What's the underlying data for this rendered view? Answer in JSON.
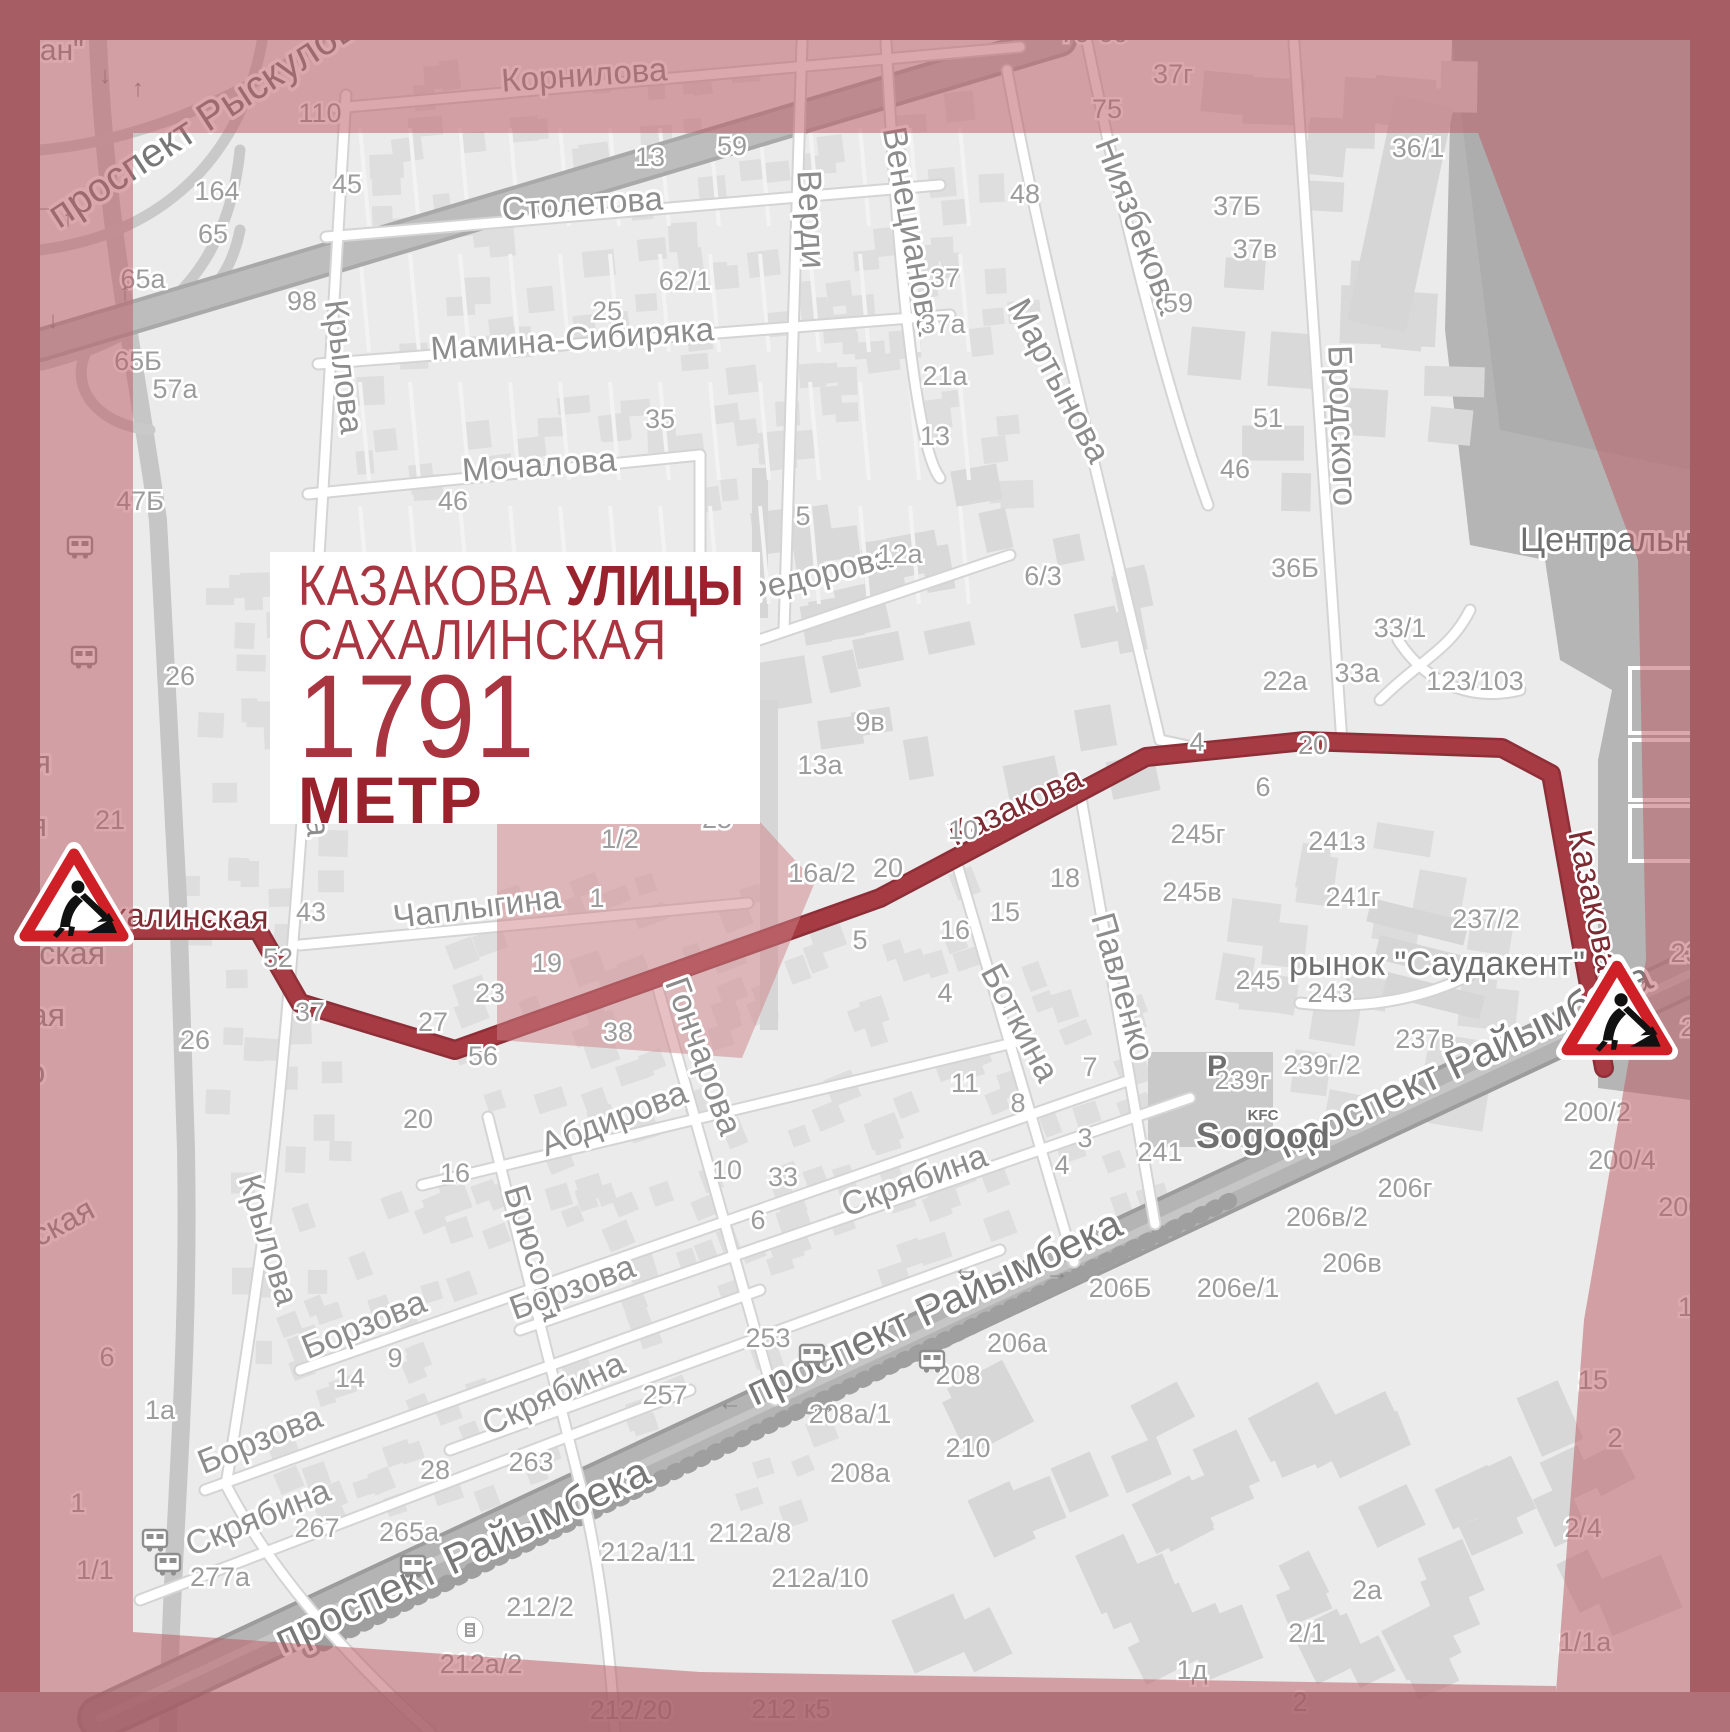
{
  "info_box": {
    "street1": "КАЗАКОВА",
    "kind": "УЛИЦЫ",
    "street2": "САХАЛИНСКАЯ",
    "distance": "1791",
    "unit": "МЕТР"
  },
  "colors": {
    "route": "#a63b44",
    "route_casing": "#8e2f38",
    "tint": "rgba(188,96,103,0.54)",
    "border": "#a65d64",
    "accent_red": "#cf2027",
    "label_gray": "#8d8d8d"
  },
  "route": {
    "name": "Казакова / Сахалинская",
    "points": [
      [
        126,
        930
      ],
      [
        258,
        930
      ],
      [
        300,
        1003
      ],
      [
        455,
        1050
      ],
      [
        880,
        898
      ],
      [
        1146,
        757
      ],
      [
        1305,
        741
      ],
      [
        1502,
        748
      ],
      [
        1551,
        774
      ],
      [
        1577,
        920
      ],
      [
        1604,
        1068
      ]
    ]
  },
  "signs": [
    {
      "name": "roadwork-sign-west"
    },
    {
      "name": "roadwork-sign-east"
    }
  ],
  "streets": [
    [
      "проспект Рыскулова",
      218,
      126,
      -33,
      40,
      "big"
    ],
    [
      "Корнилова",
      585,
      86,
      -4,
      33,
      "st"
    ],
    [
      "Столетова",
      583,
      215,
      -4,
      33,
      "st"
    ],
    [
      "Мамина-Сибиряка",
      573,
      350,
      -4,
      33,
      "st"
    ],
    [
      "Мочалова",
      540,
      476,
      -4,
      33,
      "st"
    ],
    [
      "Крылова",
      333,
      368,
      83,
      33,
      "st"
    ],
    [
      "Крылова",
      303,
      770,
      86,
      33,
      "st"
    ],
    [
      "Крылова",
      258,
      1243,
      73,
      33,
      "st"
    ],
    [
      "Верди",
      800,
      220,
      87,
      34,
      "st"
    ],
    [
      "Венецианова",
      901,
      233,
      80,
      34,
      "st"
    ],
    [
      "Мартынова",
      1049,
      386,
      62,
      34,
      "st"
    ],
    [
      "Ниязбекова",
      1128,
      230,
      69,
      34,
      "st"
    ],
    [
      "Бродского",
      1331,
      426,
      88,
      34,
      "st"
    ],
    [
      "Федорова",
      820,
      585,
      -14,
      33,
      "st"
    ],
    [
      "Чаплыгина",
      478,
      918,
      -7,
      33,
      "st"
    ],
    [
      "Сахалинская",
      168,
      927,
      1,
      33,
      "rt"
    ],
    [
      "Казакова",
      1020,
      816,
      -25,
      34,
      "rt"
    ],
    [
      "Казакова",
      1583,
      903,
      78,
      34,
      "rt"
    ],
    [
      "Гончарова",
      693,
      1060,
      70,
      34,
      "st"
    ],
    [
      "Боткина",
      1010,
      1028,
      62,
      34,
      "st"
    ],
    [
      "Павленко",
      1112,
      990,
      74,
      34,
      "st"
    ],
    [
      "Абдирова",
      618,
      1129,
      -21,
      34,
      "st"
    ],
    [
      "Брюсова",
      524,
      1256,
      73,
      34,
      "st"
    ],
    [
      "Борзова",
      368,
      1335,
      -22,
      34,
      "st"
    ],
    [
      "Борзова",
      264,
      1450,
      -22,
      34,
      "st"
    ],
    [
      "Борзова",
      576,
      1298,
      -20,
      34,
      "st"
    ],
    [
      "Скрябина",
      918,
      1191,
      -20,
      34,
      "st"
    ],
    [
      "Скрябина",
      558,
      1404,
      -25,
      34,
      "st"
    ],
    [
      "Скрябина",
      262,
      1528,
      -22,
      34,
      "st"
    ],
    [
      "проспект Райымбека",
      940,
      1320,
      -25,
      42,
      "big"
    ],
    [
      "проспект Райымбека",
      1470,
      1073,
      -25,
      42,
      "big"
    ],
    [
      "проспект Райымбека",
      468,
      1568,
      -25,
      42,
      "big"
    ],
    [
      "Центральный",
      1628,
      551,
      0,
      34,
      "dark"
    ],
    [
      "рынок \"Саудакент\"",
      1437,
      975,
      0,
      34,
      "dark"
    ],
    [
      "ауран\"",
      38,
      60,
      0,
      30,
      "st"
    ],
    [
      "ирская",
      52,
      1240,
      -28,
      32,
      "st"
    ],
    [
      "я",
      28,
      710,
      0,
      32,
      "st"
    ],
    [
      "кая",
      26,
      773,
      0,
      32,
      "st"
    ],
    [
      "кая",
      22,
      836,
      0,
      32,
      "st"
    ],
    [
      "ревская",
      46,
      964,
      0,
      32,
      "st"
    ],
    [
      "ская",
      32,
      1026,
      0,
      32,
      "st"
    ],
    [
      "ого",
      22,
      1083,
      0,
      32,
      "st"
    ]
  ],
  "numbers": [
    [
      "110",
      320,
      122
    ],
    [
      "164",
      217,
      200
    ],
    [
      "65",
      213,
      243
    ],
    [
      "45",
      347,
      193
    ],
    [
      "65а",
      143,
      288
    ],
    [
      "65Б",
      138,
      370
    ],
    [
      "98",
      302,
      310
    ],
    [
      "57а",
      175,
      398
    ],
    [
      "47Б",
      140,
      510
    ],
    [
      "26",
      180,
      685
    ],
    [
      "21",
      110,
      829
    ],
    [
      "46",
      453,
      510
    ],
    [
      "35",
      660,
      428
    ],
    [
      "13",
      650,
      166
    ],
    [
      "59",
      732,
      155
    ],
    [
      "62/1",
      685,
      290
    ],
    [
      "25",
      607,
      320
    ],
    [
      "48",
      1025,
      203
    ],
    [
      "37",
      945,
      287
    ],
    [
      "37а",
      943,
      333
    ],
    [
      "21а",
      945,
      385
    ],
    [
      "13",
      935,
      445
    ],
    [
      "5",
      803,
      525
    ],
    [
      "12а",
      900,
      563
    ],
    [
      "6/3",
      1043,
      585
    ],
    [
      "9в",
      870,
      731
    ],
    [
      "13а",
      820,
      774
    ],
    [
      "25",
      717,
      828
    ],
    [
      "1/2",
      620,
      848
    ],
    [
      "1",
      597,
      907
    ],
    [
      "132а/1",
      450,
      15
    ],
    [
      "37",
      800,
      17
    ],
    [
      "79",
      1075,
      42
    ],
    [
      "60",
      1113,
      42
    ],
    [
      "37г",
      1173,
      83
    ],
    [
      "75",
      1107,
      118
    ],
    [
      "36/1",
      1418,
      157
    ],
    [
      "37Б",
      1237,
      215
    ],
    [
      "37в",
      1255,
      258
    ],
    [
      "59",
      1178,
      312
    ],
    [
      "51",
      1268,
      427
    ],
    [
      "46",
      1235,
      478
    ],
    [
      "36Б",
      1295,
      577
    ],
    [
      "33/1",
      1400,
      637
    ],
    [
      "33а",
      1357,
      682
    ],
    [
      "22а",
      1285,
      690
    ],
    [
      "123/103",
      1475,
      690
    ],
    [
      "4",
      1197,
      751
    ],
    [
      "20",
      1313,
      754
    ],
    [
      "6",
      1263,
      796
    ],
    [
      "18",
      1065,
      887
    ],
    [
      "10",
      963,
      839
    ],
    [
      "20",
      888,
      877
    ],
    [
      "16а/2",
      822,
      882
    ],
    [
      "15",
      1005,
      921
    ],
    [
      "16",
      955,
      939
    ],
    [
      "5",
      860,
      949
    ],
    [
      "4",
      945,
      1002
    ],
    [
      "11",
      965,
      1092
    ],
    [
      "8",
      1018,
      1112
    ],
    [
      "7",
      1090,
      1076
    ],
    [
      "3",
      1085,
      1147
    ],
    [
      "4",
      1062,
      1174
    ],
    [
      "245г",
      1198,
      843
    ],
    [
      "245в",
      1192,
      901
    ],
    [
      "245",
      1258,
      989
    ],
    [
      "243",
      1330,
      1002
    ],
    [
      "241з",
      1337,
      850
    ],
    [
      "241г",
      1353,
      906
    ],
    [
      "241",
      1160,
      1161
    ],
    [
      "239г/2",
      1322,
      1074
    ],
    [
      "239г",
      1242,
      1089
    ],
    [
      "237/2",
      1486,
      928
    ],
    [
      "237в",
      1425,
      1048
    ],
    [
      "237",
      1693,
      962
    ],
    [
      "19",
      547,
      972
    ],
    [
      "23",
      490,
      1002
    ],
    [
      "27",
      433,
      1031
    ],
    [
      "37",
      310,
      1021
    ],
    [
      "52",
      278,
      967
    ],
    [
      "43",
      311,
      921
    ],
    [
      "56",
      483,
      1065
    ],
    [
      "38",
      618,
      1041
    ],
    [
      "20",
      418,
      1128
    ],
    [
      "26",
      195,
      1049
    ],
    [
      "10",
      727,
      1179
    ],
    [
      "33",
      783,
      1186
    ],
    [
      "6",
      758,
      1229
    ],
    [
      "16",
      455,
      1182
    ],
    [
      "9",
      395,
      1367
    ],
    [
      "14",
      350,
      1387
    ],
    [
      "1а",
      160,
      1419
    ],
    [
      "6",
      107,
      1366
    ],
    [
      "1",
      78,
      1512
    ],
    [
      "1/1",
      95,
      1579
    ],
    [
      "2",
      30,
      1601
    ],
    [
      "253",
      768,
      1347
    ],
    [
      "257",
      665,
      1404
    ],
    [
      "263",
      531,
      1471
    ],
    [
      "28",
      435,
      1479
    ],
    [
      "265а",
      409,
      1541
    ],
    [
      "267",
      317,
      1537
    ],
    [
      "277а",
      220,
      1586
    ],
    [
      "208а/1",
      850,
      1423
    ],
    [
      "208",
      958,
      1384
    ],
    [
      "208а",
      860,
      1482
    ],
    [
      "210",
      968,
      1457
    ],
    [
      "206а",
      1017,
      1352
    ],
    [
      "206Б",
      1120,
      1297
    ],
    [
      "206е/1",
      1238,
      1297
    ],
    [
      "206г",
      1405,
      1197
    ],
    [
      "206в/2",
      1327,
      1226
    ],
    [
      "206в",
      1352,
      1272
    ],
    [
      "212а/8",
      750,
      1542
    ],
    [
      "212а/11",
      648,
      1561
    ],
    [
      "212а/10",
      820,
      1587
    ],
    [
      "212/2",
      540,
      1616
    ],
    [
      "212а/2",
      481,
      1673
    ],
    [
      "212/20",
      631,
      1719
    ],
    [
      "212 к5",
      791,
      1718
    ],
    [
      "200/2",
      1597,
      1121
    ],
    [
      "200/4",
      1622,
      1169
    ],
    [
      "200/6",
      1692,
      1216
    ],
    [
      "200",
      1703,
      1036
    ],
    [
      "15",
      1693,
      1316
    ],
    [
      "15",
      1593,
      1389
    ],
    [
      "2",
      1615,
      1447
    ],
    [
      "2/4",
      1583,
      1537
    ],
    [
      "1/1а",
      1585,
      1651
    ],
    [
      "2а",
      1367,
      1599
    ],
    [
      "2/1",
      1307,
      1642
    ],
    [
      "1д",
      1192,
      1679
    ],
    [
      "2",
      1300,
      1711
    ]
  ],
  "pois": [
    {
      "label": "Sogood",
      "x": 1263,
      "y": 1148,
      "size": 36
    },
    {
      "label": "KFC",
      "x": 1263,
      "y": 1120,
      "size": 15
    },
    {
      "label": "P",
      "x": 1217,
      "y": 1076,
      "size": 30
    }
  ],
  "icons": {
    "buses": [
      [
        80,
        547
      ],
      [
        84,
        657
      ],
      [
        155,
        1540
      ],
      [
        168,
        1564
      ],
      [
        812,
        1355
      ],
      [
        932,
        1361
      ],
      [
        413,
        1566
      ],
      [
        1712,
        1008
      ]
    ],
    "fuel": [
      [
        470,
        1630
      ]
    ],
    "arrows": [
      [
        "←",
        965,
        1276
      ],
      [
        "→",
        1057,
        1280
      ],
      [
        "←",
        730,
        1410
      ],
      [
        "→",
        825,
        1413
      ],
      [
        "→",
        1638,
        986
      ],
      [
        "↓",
        105,
        83
      ],
      [
        "↑",
        138,
        96
      ],
      [
        "←",
        42,
        213
      ],
      [
        "↑",
        68,
        226
      ],
      [
        "↓",
        53,
        328
      ],
      [
        "↓",
        24,
        336
      ],
      [
        "↑",
        125,
        300
      ]
    ]
  }
}
